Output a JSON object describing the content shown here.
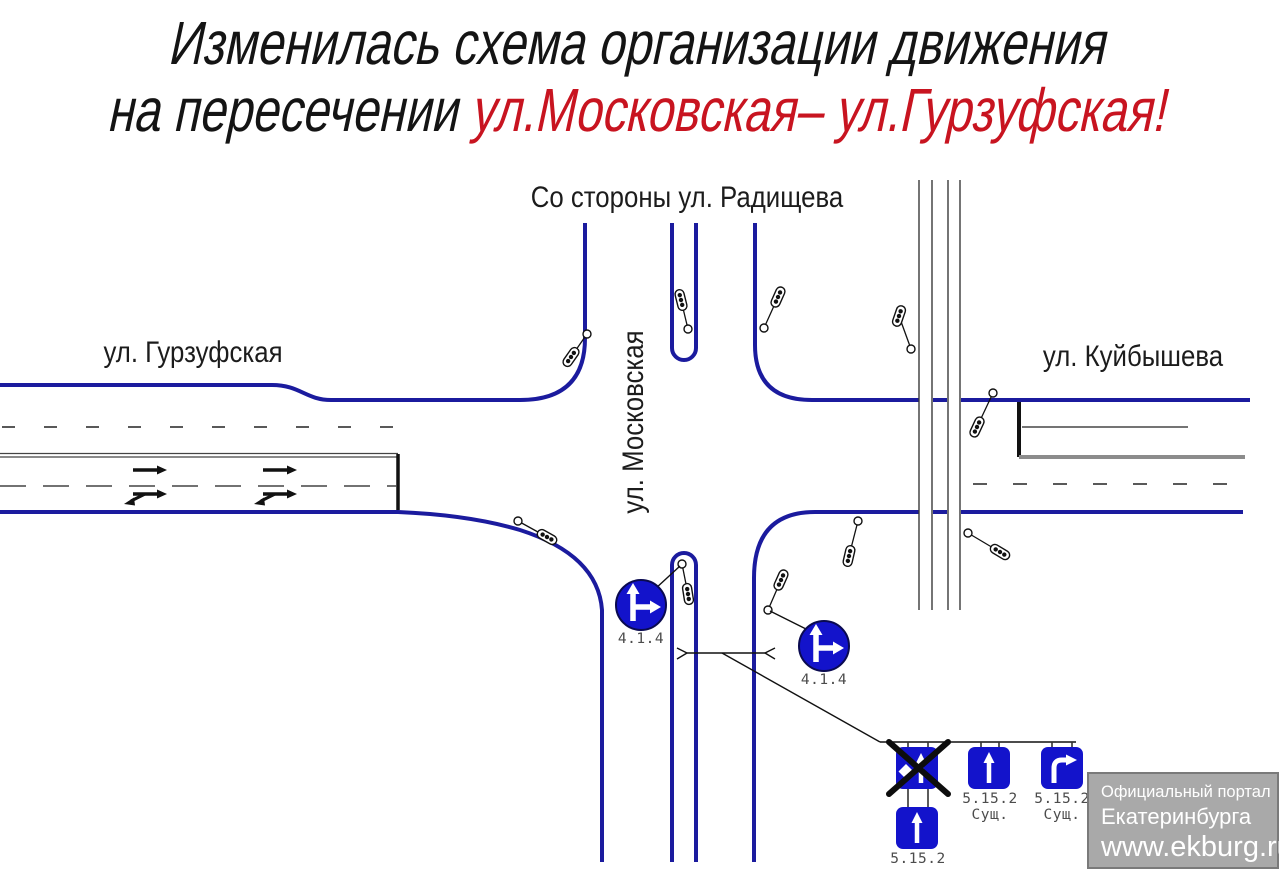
{
  "title": {
    "line1": "Изменилась схема организации движения",
    "line2_black": "на пересечении ",
    "line2_red": "ул.Московская– ул.Гурзуфская!"
  },
  "street_labels": {
    "from_radishcheva": "Со стороны ул. Радищева",
    "gurzufskaya": "ул. Гурзуфская",
    "kuibysheva": "ул. Куйбышева",
    "moskovskaya": "ул. Московская"
  },
  "road_signs": {
    "round_sign_1": {
      "code": "4.1.4"
    },
    "round_sign_2": {
      "code": "4.1.4"
    },
    "lane_sign_new_straight": {
      "code": "5.15.2"
    },
    "lane_sign_existing_straight": {
      "code": "5.15.2",
      "note": "Сущ."
    },
    "lane_sign_existing_right": {
      "code": "5.15.2",
      "note": "Сущ."
    }
  },
  "watermark": {
    "line1": "Официальный портал",
    "line2": "Екатеринбурга",
    "line3": "www.ekburg.ru"
  },
  "colors": {
    "road_edge_blue": "#1b1b9e",
    "sign_blue": "#1313cb",
    "title_red": "#c81420",
    "label_gray": "#4c4c4c",
    "watermark_bg": "#a9a9a9"
  }
}
